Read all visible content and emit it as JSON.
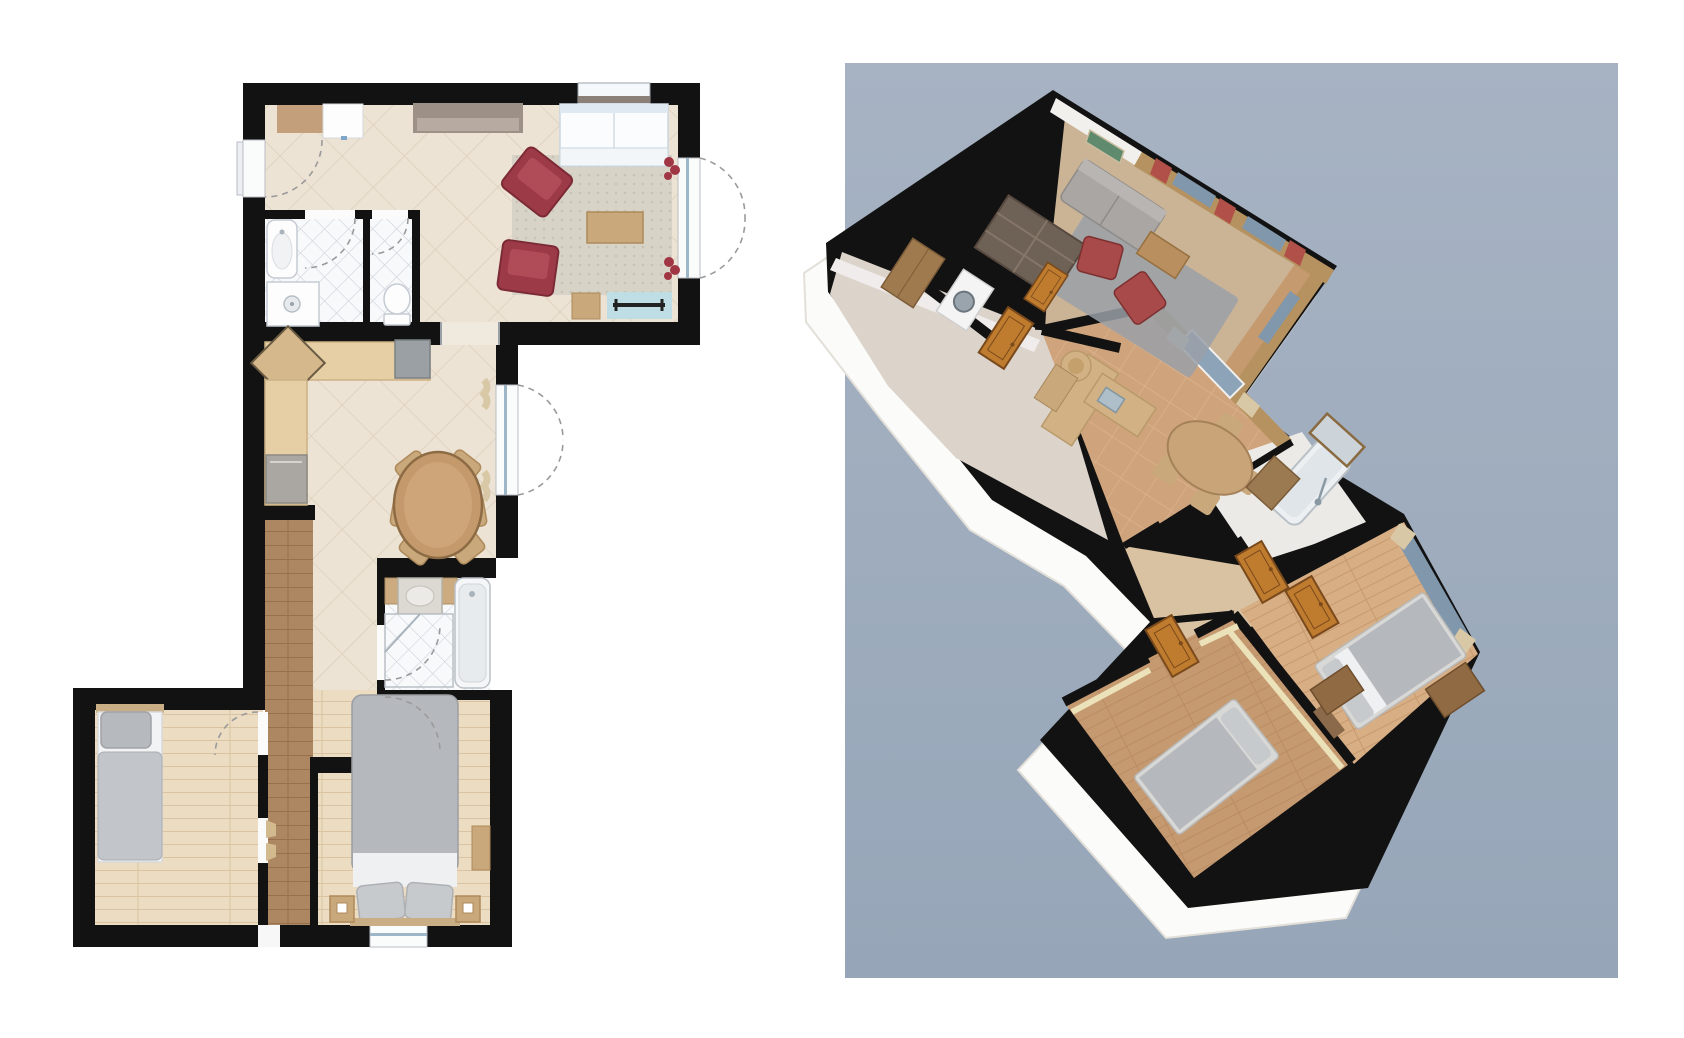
{
  "page": {
    "background": "#ffffff"
  },
  "panels": {
    "floor_plan_2d": {
      "name": "2d-floor-plan",
      "rooms": [
        {
          "name": "living-room",
          "furniture": [
            "corner-sofa",
            "armchair",
            "armchair",
            "coffee-table",
            "area-rug",
            "sideboard",
            "console-cabinet",
            "white-cabinet",
            "bench",
            "side-stool",
            "teal-doormat",
            "window-plant",
            "window-plant"
          ]
        },
        {
          "name": "bathroom",
          "furniture": [
            "washbasin",
            "shower",
            "floor-drain"
          ]
        },
        {
          "name": "wc",
          "furniture": [
            "toilet"
          ]
        },
        {
          "name": "kitchen-dining",
          "furniture": [
            "kitchen-counter",
            "corner-unit",
            "sink-appliance",
            "fridge",
            "oval-dining-table",
            "dining-chair",
            "dining-chair",
            "dining-chair",
            "dining-chair",
            "dining-chair",
            "dining-chair"
          ]
        },
        {
          "name": "hallway",
          "furniture": [
            "runner-floor",
            "interior-door",
            "interior-door"
          ]
        },
        {
          "name": "bathroom-2",
          "furniture": [
            "vanity-basin",
            "bathtub",
            "shower"
          ]
        },
        {
          "name": "small-bedroom",
          "furniture": [
            "single-bed"
          ]
        },
        {
          "name": "master-bedroom",
          "furniture": [
            "double-bed",
            "nightstand",
            "nightstand",
            "wardrobe"
          ]
        }
      ]
    },
    "view_3d": {
      "name": "3d-isometric-view",
      "rooms": [
        {
          "name": "living-room",
          "furniture": [
            "bookshelf",
            "sofa",
            "armchair",
            "armchair",
            "coffee-table",
            "rug",
            "painting",
            "red-curtains",
            "windows"
          ]
        },
        {
          "name": "utility-entry",
          "furniture": [
            "washing-machine",
            "wardrobe",
            "interior-door",
            "interior-door",
            "front-door"
          ]
        },
        {
          "name": "kitchen-dining",
          "furniture": [
            "counter",
            "corner-shelf",
            "sink",
            "french-door",
            "curtains",
            "oval-table",
            "chairs"
          ]
        },
        {
          "name": "bathroom-2",
          "furniture": [
            "bathtub",
            "shower-set",
            "vanity",
            "mirror-window"
          ]
        },
        {
          "name": "hallway",
          "furniture": [
            "interior-door",
            "interior-door"
          ]
        },
        {
          "name": "small-bedroom",
          "furniture": [
            "single-bed",
            "wall-shelf",
            "interior-door"
          ]
        },
        {
          "name": "master-bedroom",
          "furniture": [
            "double-bed",
            "wardrobe",
            "wardrobe",
            "curtained-window"
          ]
        }
      ]
    }
  },
  "palette": {
    "page_bg": "#ffffff",
    "wall": "#121212",
    "bg3d_top": "#a7b3c3",
    "bg3d_bottom": "#96a6b8",
    "tile_floor": "#ece3d4",
    "tile_line": "#ddcfbc",
    "bath_tile": "#f8f9fb",
    "bath_line": "#ccd3da",
    "wood_light": "#ecdcc2",
    "wood_line": "#d9c3a3",
    "runner": "#ad8762",
    "runner_line": "#97714e",
    "rug": "#d7d3c7",
    "rug_dot": "#c8c3b5",
    "sofa_white": "#fbfcfd",
    "sofa_edge": "#c9d6e0",
    "armchair_red": "#9d3a47",
    "armchair_red_dark": "#7c2a36",
    "table_tan": "#c9a87b",
    "table_edge": "#ae8a5a",
    "dining_table": "#c49a6c",
    "dining_edge": "#8d6b44",
    "counter": "#e6cfa5",
    "counter_edge": "#cbb183",
    "appliance_gray": "#9aa0a4",
    "fridge": "#aaa6a1",
    "sideboard": "#9c9087",
    "sideboard_light": "#b7aba1",
    "teal_mat": "#bedde4",
    "fixture_white": "#fdfdfe",
    "fixture_line": "#c5cbd3",
    "bed_duvet": "#b5b8bc",
    "bed_pillow": "#c7cacd",
    "bed_sheet": "#eef0f1",
    "headboard": "#c8ad85",
    "glass_blue": "#9db6c8",
    "swing": "#9a9a9a",
    "plant_red": "#a03543",
    "wall_face3d": "#f2f0ed",
    "pale_floor3d": "#dcd4cb",
    "wood_wall3d": "#b5925f",
    "floor_tile3d": "#cfa37b",
    "floor_tile3d_line": "#dbb58f",
    "carpet3d": "#9aa0a8",
    "sofa3d": "#a9a6a3",
    "red3d": "#a84a4a",
    "curtain_red": "#b15048",
    "curtain_tan": "#d8c8a6",
    "glass3d": "#8197ac",
    "door3d": "#c07c2e",
    "door3d_frame": "#7a4a1c",
    "bookshelf3d": "#6e6156",
    "floor_bed1_3d": "#c69a71",
    "floor_master3d": "#d8ae85",
    "hall_floor3d": "#d9c2a2",
    "yellow_wall3d": "#ece2ba",
    "tub3d": "#edf0f2",
    "chrome3d": "#8a9aa5",
    "counter3d": "#d2b284",
    "slab_white3d": "#fbfbf9",
    "living_floor3d": "#cbb396"
  }
}
